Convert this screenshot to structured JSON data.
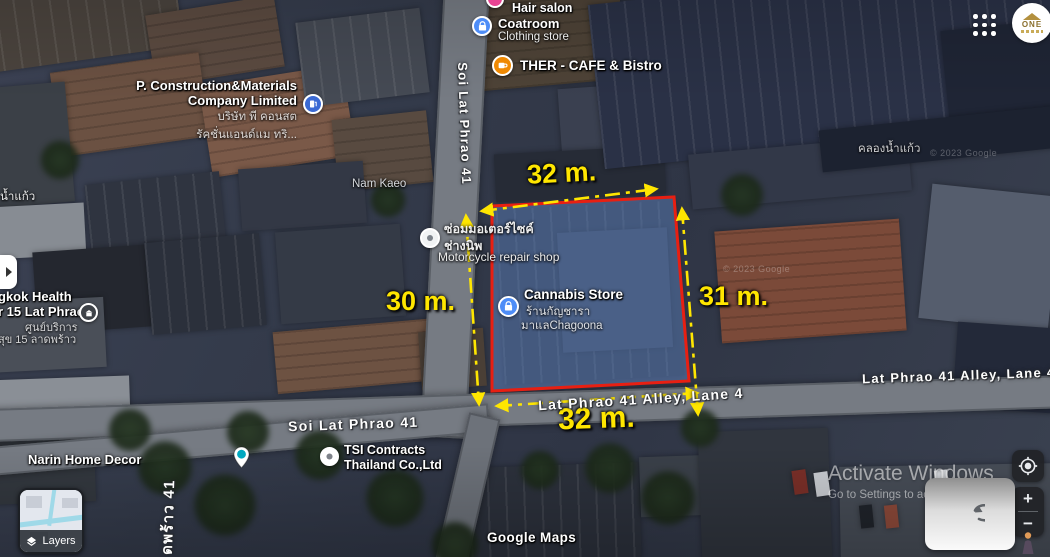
{
  "colors": {
    "dimension_yellow": "#ffe600",
    "plot_outline_red": "#e81f12",
    "plot_fill_blue": "rgba(105,145,210,0.45)",
    "poi_blue": "#4e8df7",
    "cafe_orange": "#ef8903",
    "pin_teal": "#00a8c0"
  },
  "plot": {
    "dim_top": "32 m.",
    "dim_left": "30 m.",
    "dim_right": "31 m.",
    "dim_bottom": "32 m."
  },
  "pois": {
    "hair_salon": {
      "name": "Hair salon"
    },
    "coatroom": {
      "name": "Coatroom",
      "type": "Clothing store"
    },
    "cafe": {
      "name": "THER - CAFE & Bistro"
    },
    "construction": {
      "name_line1": "P. Construction&Materials",
      "name_line2": "Company Limited",
      "thai_line1": "บริษัท พี คอนสต",
      "thai_line2": "รัคชั่นแอนด์แม ทริ..."
    },
    "motorcycle": {
      "thai_line1": "ซ่อมมอเตอร์ไซค์",
      "thai_line2": "ช่างนิพ",
      "name": "Motorcycle repair shop"
    },
    "cannabis": {
      "name": "Cannabis Store",
      "thai_line1": "ร้านกัญชารา",
      "thai_line2": "มาแลChagoona"
    },
    "health": {
      "name_line1": "gkok Health",
      "name_line2": "r 15 Lat Phrao",
      "thai_line1": "ศูนย์บริการ",
      "thai_line2": "สุข 15 ลาดพร้าว"
    },
    "narin": {
      "name": "Narin Home Decor"
    },
    "tsi": {
      "name_line1": "TSI Contracts",
      "name_line2": "Thailand Co.,Ltd"
    }
  },
  "streets": {
    "soi_vertical": "Soi Lat Phrao 41",
    "soi_bottom": "Soi Lat Phrao 41",
    "alley_center": "Lat Phrao 41 Alley, Lane 4",
    "alley_right": "Lat Phrao 41 Alley, Lane 4",
    "thai_vertical": "ดพร้าว 41",
    "nam_kaeo": "Nam Kaeo",
    "canal": "คลองน้ำแก้ว",
    "nam_kaeo_left": "น้ำแก้ว"
  },
  "controls": {
    "layers": "Layers",
    "zoom_in": "+",
    "zoom_out": "−"
  },
  "attribution": {
    "google": "Google Maps",
    "copyright": "© 2023 Google"
  },
  "os_watermark": {
    "line1": "Activate Windows",
    "line2": "Go to Settings to activate Windows"
  },
  "logo_text": "ONE"
}
